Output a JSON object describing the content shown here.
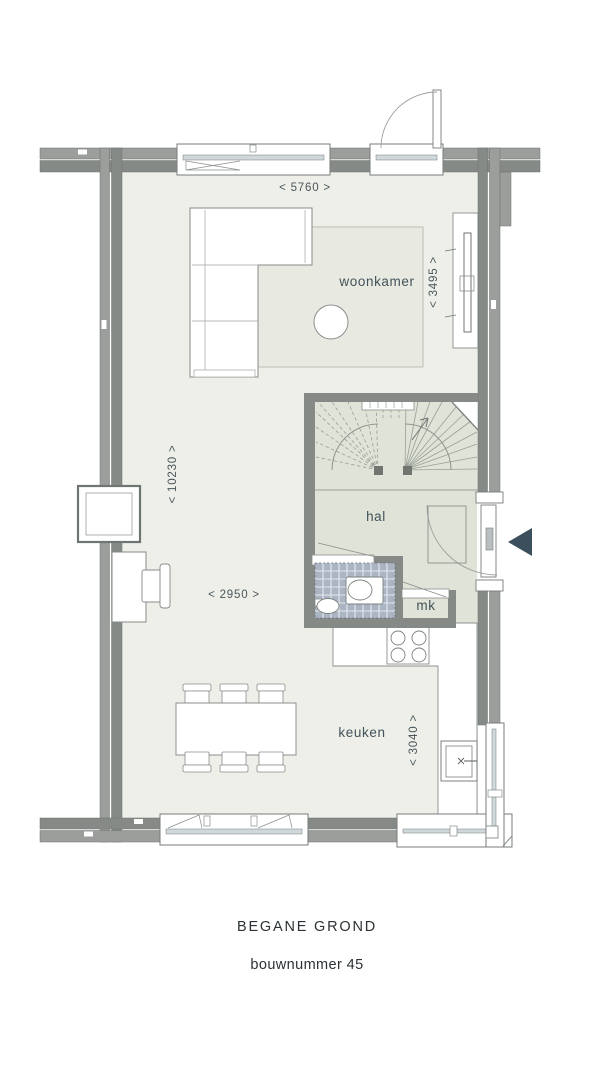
{
  "caption": {
    "floor": "BEGANE GROND",
    "build_number": "bouwnummer 45"
  },
  "rooms": {
    "living_room": "woonkamer",
    "hall": "hal",
    "kitchen": "keuken",
    "meter_cupboard": "mk"
  },
  "dimensions": {
    "living_width": "< 5760 >",
    "living_depth": "< 3495 >",
    "house_depth": "< 10230 >",
    "dining_width": "< 2950 >",
    "kitchen_depth": "< 3040 >"
  },
  "palette": {
    "wall_dark": "#868a87",
    "wall_light": "#9b9e9b",
    "floor": "#edefe8",
    "hall_floor": "#e0e3d7",
    "tiles": "#aab4c3",
    "glass": "#cfd8db",
    "entrance_arrow": "#3b4f5c",
    "label_text": "#43525a",
    "caption_text": "#2b3134"
  }
}
